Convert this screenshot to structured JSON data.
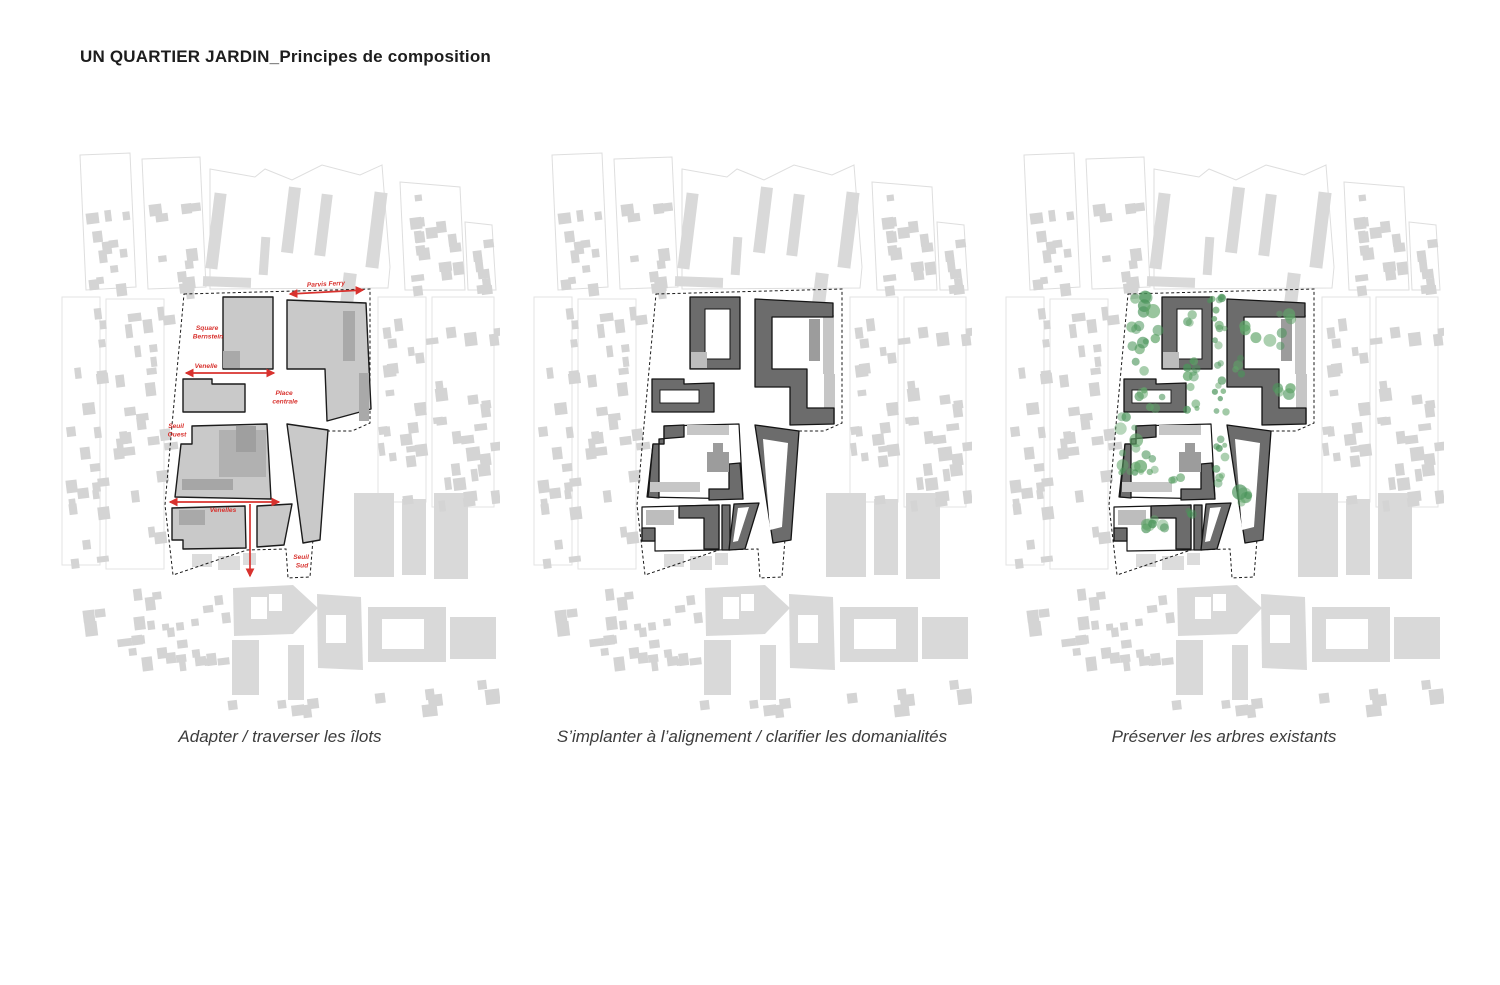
{
  "title": "UN QUARTIER JARDIN_Principes de composition",
  "panels": [
    {
      "caption": "Adapter / traverser les îlots"
    },
    {
      "caption": "S’implanter à l’alignement / clarifier les domanialités"
    },
    {
      "caption": "Préserver les arbres existants"
    }
  ],
  "map_labels": {
    "parvis_ferry": "Parvis Ferry",
    "square_bernstein_1": "Square",
    "square_bernstein_2": "Bernstein",
    "venelle": "Venelle",
    "place_centrale_1": "Place",
    "place_centrale_2": "centrale",
    "seuil_ouest_1": "Seuil",
    "seuil_ouest_2": "Ouest",
    "venelles": "Venelles",
    "seuil_sud_1": "Seuil",
    "seuil_sud_2": "Sud"
  },
  "colors": {
    "accent_red": "#d8322e",
    "context_building": "#d4d4d4",
    "site_building_light": "#c9c9c9",
    "site_building_dark": "#6c6c6c",
    "tree": "#5fa468",
    "tree_dark": "#4a945a"
  },
  "context_blob_fields": [
    [
      25,
      62,
      45,
      78,
      12,
      6,
      13
    ],
    [
      88,
      56,
      52,
      84,
      14,
      6,
      13
    ],
    [
      345,
      48,
      55,
      92,
      16,
      6,
      13
    ],
    [
      406,
      84,
      26,
      56,
      7,
      6,
      12
    ],
    [
      2,
      152,
      38,
      266,
      22,
      6,
      13
    ],
    [
      46,
      152,
      58,
      270,
      26,
      6,
      14
    ],
    [
      318,
      150,
      48,
      205,
      22,
      6,
      13
    ],
    [
      372,
      150,
      62,
      210,
      26,
      6,
      14
    ],
    [
      15,
      440,
      86,
      74,
      14,
      7,
      15
    ],
    [
      100,
      444,
      20,
      70,
      7,
      6,
      11
    ],
    [
      126,
      443,
      36,
      72,
      9,
      7,
      13
    ],
    [
      306,
      520,
      120,
      40,
      6,
      9,
      16
    ],
    [
      150,
      552,
      120,
      16,
      5,
      8,
      14
    ]
  ],
  "trees": {
    "clusters": [
      [
        140,
        158,
        13,
        10,
        6,
        4,
        8
      ],
      [
        143,
        202,
        16,
        26,
        11,
        3,
        6
      ],
      [
        188,
        215,
        6,
        48,
        14,
        2.5,
        5
      ],
      [
        216,
        208,
        7,
        58,
        18,
        2.5,
        5.5
      ],
      [
        238,
        218,
        8,
        9,
        4,
        3,
        5
      ],
      [
        262,
        182,
        28,
        20,
        9,
        3,
        6.5
      ],
      [
        281,
        240,
        9,
        14,
        4,
        4,
        7
      ],
      [
        148,
        252,
        13,
        10,
        6,
        3,
        6
      ],
      [
        136,
        298,
        20,
        30,
        13,
        3,
        7
      ],
      [
        132,
        328,
        16,
        5,
        6,
        2.5,
        4
      ],
      [
        171,
        328,
        6,
        6,
        3,
        3,
        5
      ],
      [
        217,
        312,
        5,
        28,
        9,
        2.5,
        4.5
      ],
      [
        243,
        352,
        8,
        7,
        5,
        4,
        8
      ],
      [
        154,
        377,
        16,
        6,
        7,
        3.5,
        6.5
      ],
      [
        187,
        369,
        5,
        7,
        3,
        3,
        5
      ],
      [
        211,
        153,
        9,
        5,
        3,
        2.5,
        4.5
      ]
    ]
  }
}
